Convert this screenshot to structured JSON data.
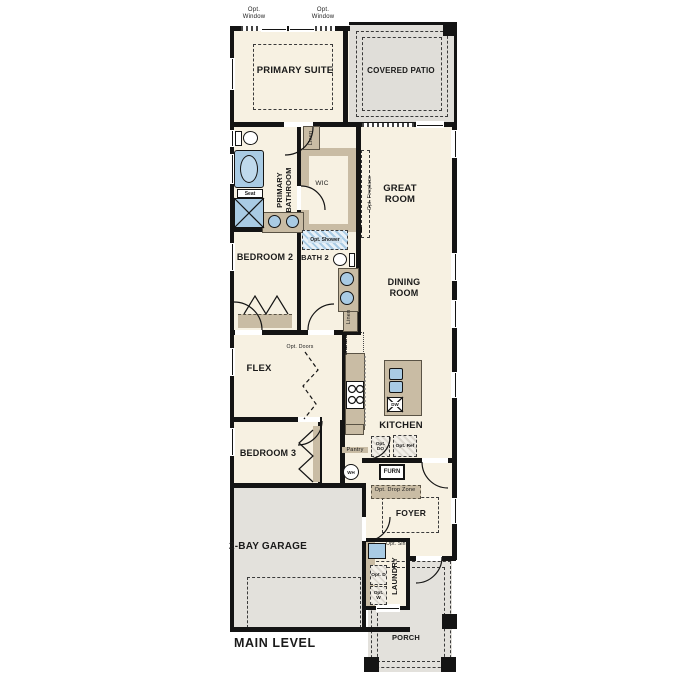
{
  "level_label": "MAIN LEVEL",
  "rooms": {
    "primary_suite": "PRIMARY SUITE",
    "covered_patio": "COVERED PATIO",
    "great_room": "GREAT ROOM",
    "primary_bathroom": "PRIMARY BATHROOM",
    "wic": "WIC",
    "bedroom_2": "BEDROOM 2",
    "bath_2": "BATH 2",
    "dining_room": "DINING ROOM",
    "flex": "FLEX",
    "kitchen": "KITCHEN",
    "bedroom_3": "BEDROOM 3",
    "foyer": "FOYER",
    "laundry": "LAUNDRY",
    "garage": "2-BAY GARAGE",
    "porch": "PORCH"
  },
  "closets": {
    "linen_upper": "Linen",
    "linen_hall": "Linen",
    "pantry": "Pantry"
  },
  "options": {
    "opt_window_left": "Opt. Window",
    "opt_window_right": "Opt. Window",
    "opt_fireplace": "Opt. Fireplace",
    "opt_shower": "Opt. Shower",
    "opt_doors": "Opt. Doors",
    "opt_double_oven": "Opt. DO",
    "opt_refrigerator": "Opt. Ref",
    "opt_drop_zone": "Opt. Drop Zone",
    "opt_sink": "Opt. Sink",
    "opt_dryer": "Opt. D",
    "opt_washer": "Opt. W"
  },
  "equipment": {
    "water_heater": "WH",
    "furnace": "FURN",
    "dishwasher": "DW",
    "shower_seat": "Seat"
  },
  "colors": {
    "background": "#FFFFFF",
    "floor": "#F7F1E2",
    "concrete": "#E3E1DC",
    "cabinetry": "#C9BCA4",
    "plumbing_blue": "#A9CBE4",
    "wall": "#141414",
    "text": "#1A1A1A"
  }
}
